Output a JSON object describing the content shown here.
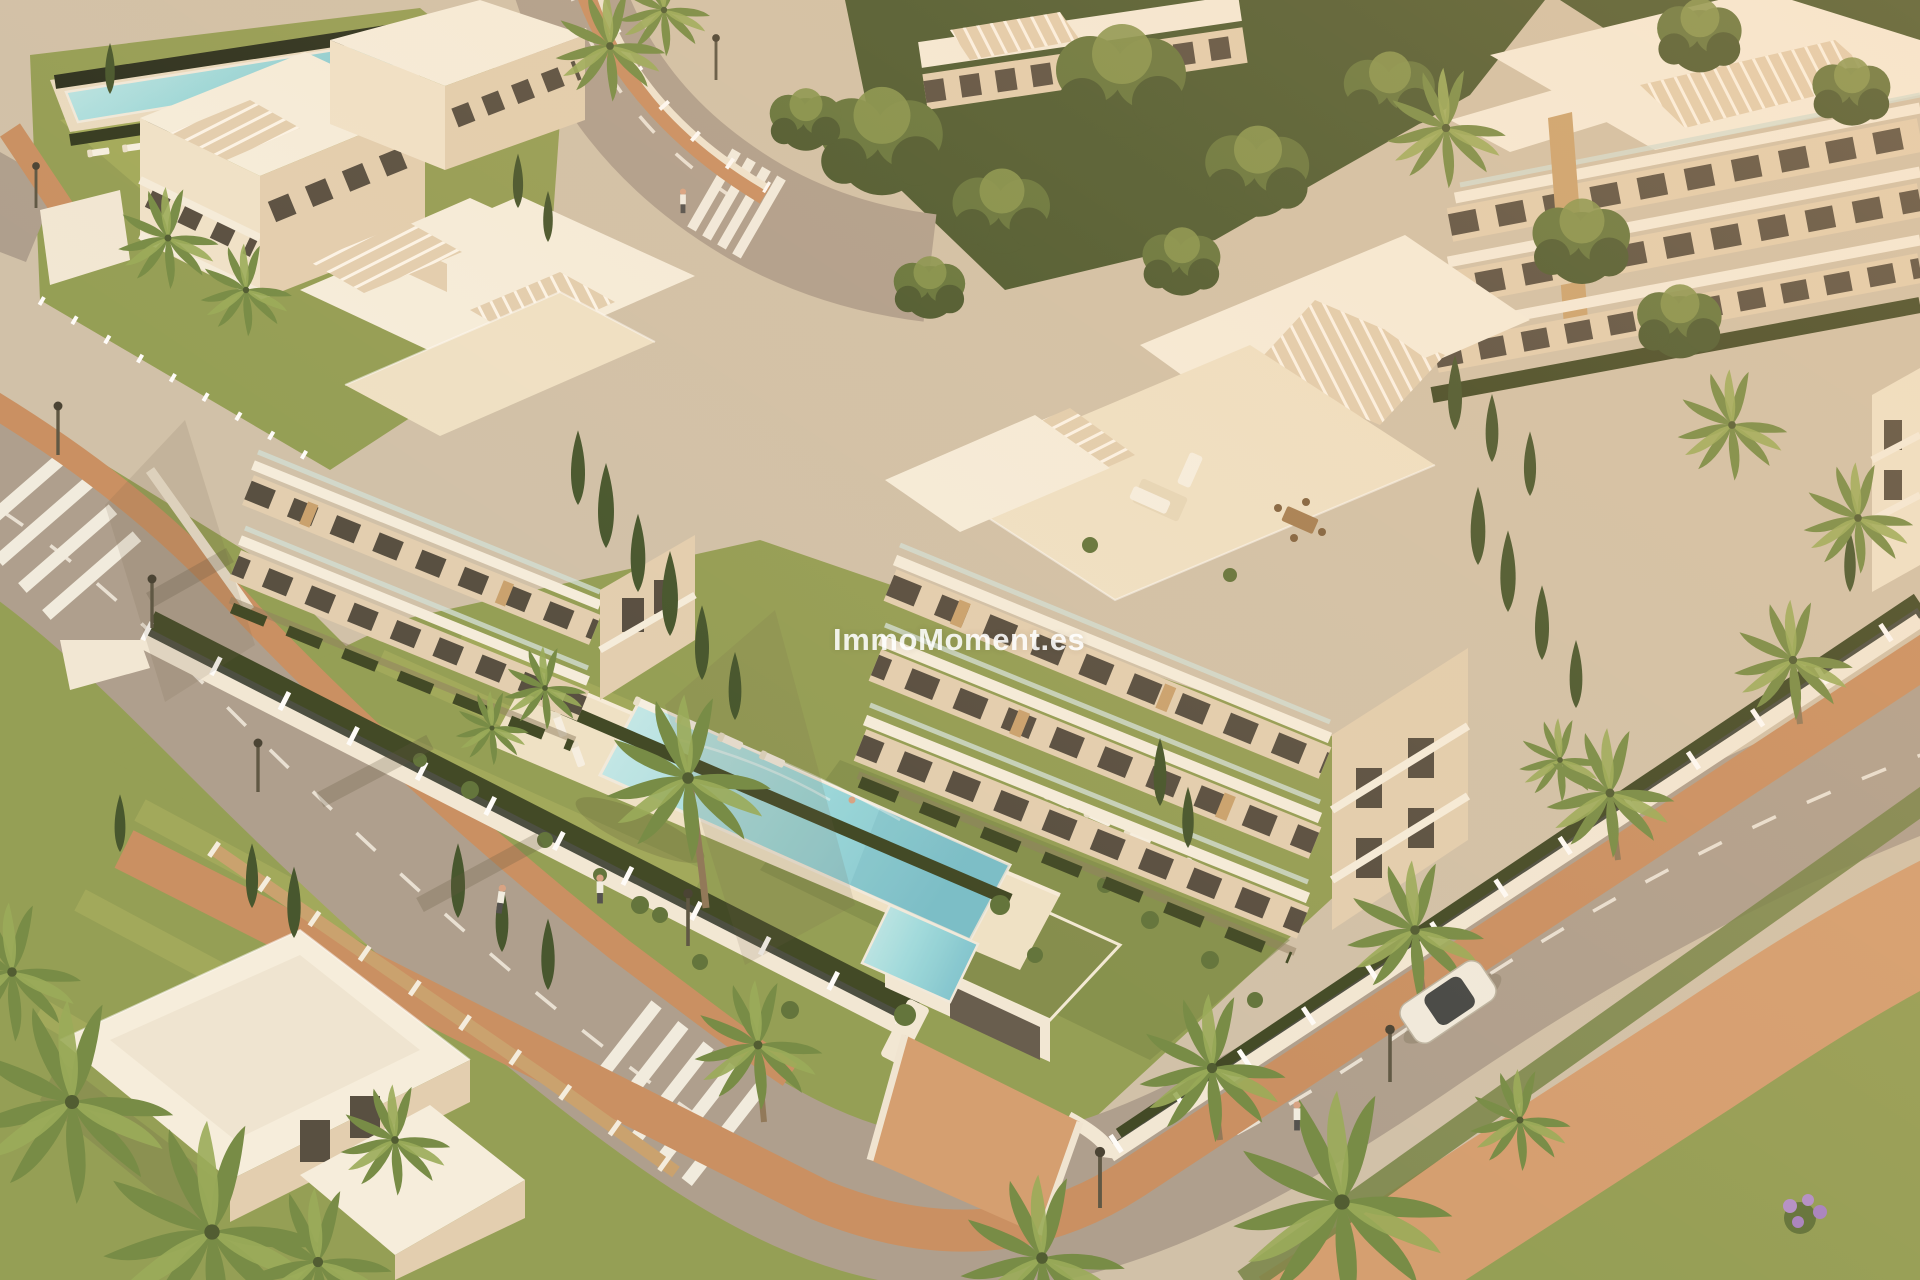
{
  "watermark": {
    "text": "ImmoMoment.es"
  },
  "colors": {
    "base": "#cfc1aa",
    "road": "#ab9d8d",
    "road_light": "#bfb1a1",
    "dash": "#f3efe5",
    "terracotta": "#c78c5f",
    "terracotta_light": "#d39c6e",
    "grass": "#8f9c51",
    "grass_light": "#a9b15e",
    "grass_dark": "#6f7f42",
    "hedge": "#36411f",
    "tree_dark": "#3f5128",
    "tree_mid": "#5a6f36",
    "tree_light": "#7d9048",
    "cypress": "#3c4f27",
    "palm": "#6f8841",
    "palm_light": "#95aa55",
    "roof": "#f7f0e1",
    "facade": "#f0e4cd",
    "facade_shade": "#e2cfb2",
    "shadow_warm": "#c4b192",
    "window": "#4e473c",
    "wood": "#c8a06c",
    "wall": "#f3ead9",
    "railing": "#41463c",
    "pool_light": "#c8ecee",
    "pool_deep": "#7cc5d2",
    "deck": "#efe3c9",
    "watermark_color": "#ffffff"
  }
}
